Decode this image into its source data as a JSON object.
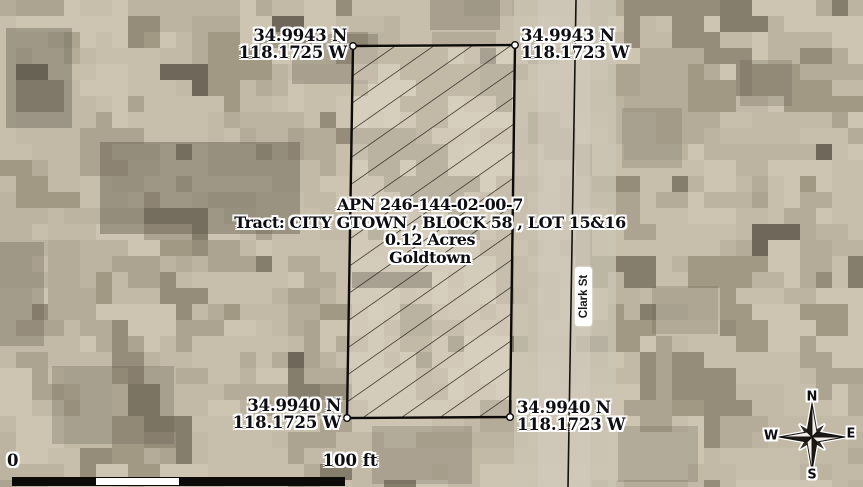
{
  "parcel": {
    "info_lines": {
      "apn": "APN 246-144-02-00-7",
      "tract": "Tract: CITY GTOWN , BLOCK 58 , LOT 15&16",
      "acres": "0.12 Acres",
      "city": "Goldtown"
    },
    "corners": {
      "top_left": {
        "lat": "34.9943 N",
        "lon": "118.1725 W"
      },
      "top_right": {
        "lat": "34.9943 N",
        "lon": "118.1723 W"
      },
      "bottom_left": {
        "lat": "34.9940 N",
        "lon": "118.1725 W"
      },
      "bottom_right": {
        "lat": "34.9940 N",
        "lon": "118.1723 W"
      }
    }
  },
  "street": {
    "name": "Clark St"
  },
  "scale_bar": {
    "start": "0",
    "end": "100 ft"
  },
  "compass": {
    "n": "N",
    "e": "E",
    "s": "S",
    "w": "W"
  },
  "colors": {
    "label_text": "#0d0d12",
    "label_halo": "#ffffff",
    "parcel_outline": "#0c0b09",
    "hatch_line": "#1c1a16",
    "road_line": "#14120f",
    "terrain_palette": [
      "#cdc5b2",
      "#c7beab",
      "#c2b9a6",
      "#bcb3a0",
      "#b4ab98",
      "#aca390",
      "#a29985",
      "#958c7a",
      "#867e6d",
      "#6f685a"
    ]
  }
}
